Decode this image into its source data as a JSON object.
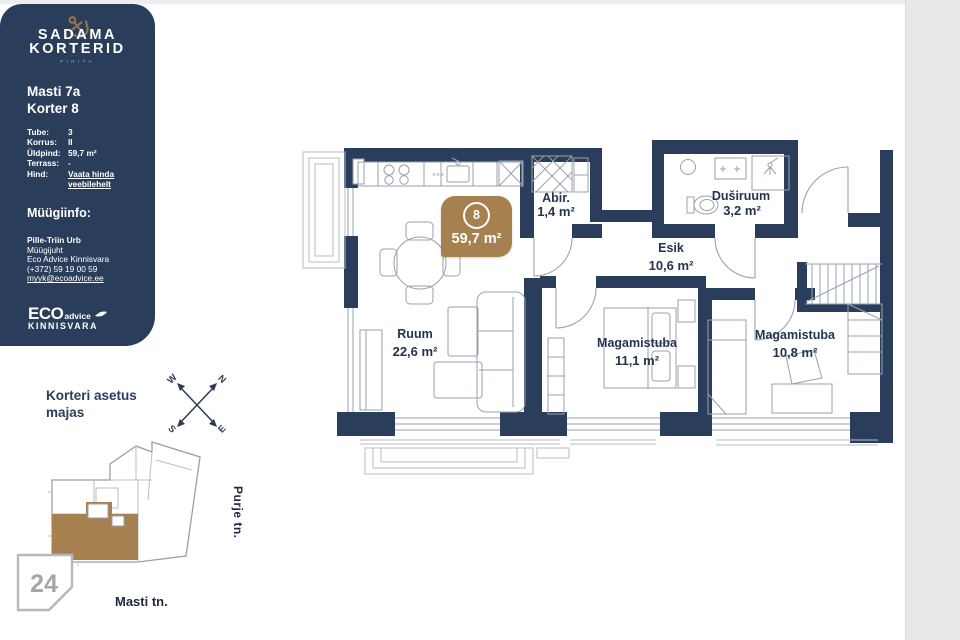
{
  "colors": {
    "navy": "#2a3e5c",
    "brown": "#a7804f",
    "gold": "#8d744c",
    "plan_text": "#24344f"
  },
  "sidebar": {
    "brand_line1": "SADAMA",
    "brand_line2": "KORTERID",
    "brand_sub": "PIRITA",
    "address": "Masti 7a",
    "unit": "Korter 8",
    "details": [
      {
        "label": "Tube:",
        "value": "3"
      },
      {
        "label": "Korrus:",
        "value": "II"
      },
      {
        "label": "Üldpind:",
        "value": "59,7 m²"
      },
      {
        "label": "Terrass:",
        "value": "-"
      },
      {
        "label": "Hind:",
        "value_line1": "Vaata hinda",
        "value_line2": "veebilehelt"
      }
    ],
    "sales_heading": "Müügiinfo:",
    "agent_name": "Pille-Triin Urb",
    "agent_role": "Müügijuht",
    "agent_company": "Eco Advice Kinnisvara",
    "agent_phone": "(+372) 59 19 00 59",
    "agent_email": "myyk@ecoadvice.ee",
    "logo_eco": "ECO",
    "logo_advice": "advice",
    "logo_kinnisvara": "KINNISVARA"
  },
  "location": {
    "heading_line1": "Korteri asetus",
    "heading_line2": "majas",
    "compass_w": "W",
    "compass_n": "N",
    "compass_s": "S",
    "compass_e": "E",
    "plot_number": "24",
    "street_bottom": "Masti tn.",
    "street_right": "Purje tn."
  },
  "floorplan": {
    "badge_number": "8",
    "badge_area": "59,7 m²",
    "rooms": [
      {
        "name": "Ruum",
        "area": "22,6 m²"
      },
      {
        "name": "Abir.",
        "area": "1,4 m²"
      },
      {
        "name": "Duširuum",
        "area": "3,2 m²"
      },
      {
        "name": "Esik",
        "area": "10,6 m²"
      },
      {
        "name": "Magamistuba",
        "area": "11,1 m²"
      },
      {
        "name": "Magamistuba",
        "area": "10,8 m²"
      }
    ]
  }
}
